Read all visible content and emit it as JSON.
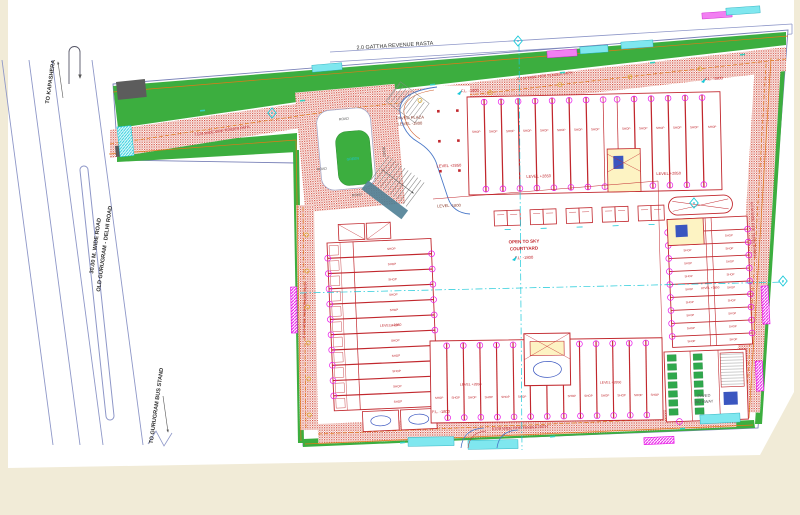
{
  "canvas": {
    "background": "#f1ebd7",
    "sheet": "#ffffff"
  },
  "colors": {
    "green": "#3cae3f",
    "hatch_red": "#d2493a",
    "building_red": "#c1272d",
    "magenta": "#e816e8",
    "cyan": "#19c8d8",
    "orange": "#e07818",
    "road_line": "#8e97c8",
    "yellow": "#d9a91f",
    "lift_blue": "#3a56c0"
  },
  "roads": {
    "left": {
      "to_top": "TO KAPASHERA",
      "name_line1": "30.00 M. WIDE ROAD",
      "name_line2": "OLD GURUGRAM - DELHI ROAD",
      "to_bottom": "TO GURUGRAM BUS STAND"
    },
    "top": {
      "label": "2.0 GATTHA REVENUE RASTA"
    }
  },
  "site": {
    "fire_path_label": "6.0 M WIDE FIRE TENDER PATH",
    "access_road_label": "7.5 M WIDE FIRE TENDER PATH",
    "roundabout": {
      "road": "ROAD",
      "green": "GREEN"
    },
    "plaza": {
      "line1": "PAVED PLAZA",
      "line2": "LEVEL -1800"
    },
    "levels": {
      "upper": "LEVEL +2850",
      "lower": "LEVEL -1800",
      "ffl": "F.L. -1800"
    },
    "courtyard": {
      "line1": "OPEN TO SKY",
      "line2": "COURTYARD",
      "ffl": "F.L. -1800"
    },
    "pathway": {
      "line1": "PAVED",
      "line2": "PATHWAY"
    },
    "shop": "SHOP"
  }
}
